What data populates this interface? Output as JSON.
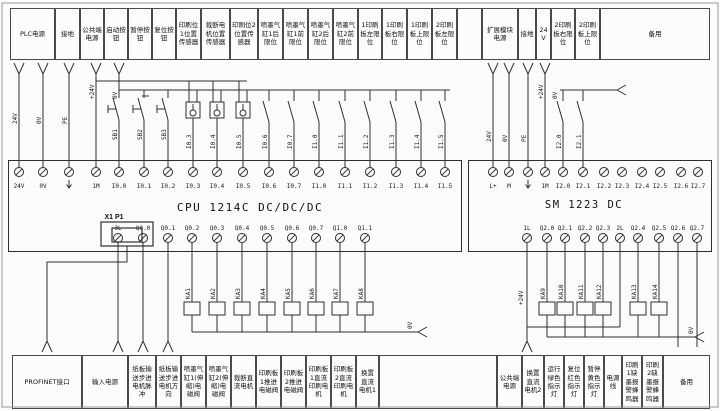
{
  "colors": {
    "line": "#2f2f2f",
    "box_border": "#4a4a4a",
    "background": "#fbfbfb",
    "text": "#111111"
  },
  "icons": {
    "ground_terminal": "ground-arrow-icon",
    "cable_entry": "v-arrow-icon",
    "wire_continuation": "fork-arrow-icon",
    "terminal": "screw-terminal-icon",
    "ethernet_port": "rj45-port-icon",
    "relay_coil": "relay-coil-icon",
    "proximity_sensor": "proximity-sensor-icon"
  },
  "top_row": [
    "PLC电源",
    "接地",
    "公共端电源",
    "启动按钮",
    "暂停按钮",
    "复位按钮",
    "印刷位1位置传感器",
    "裁断电机位置传感器",
    "印刷位2位置传感器",
    "喷墨气缸1后限位",
    "喷墨气缸1前限位",
    "喷墨气缸2后限位",
    "喷墨气缸2前限位",
    "1印刷板左限位",
    "1印刷板右限位",
    "1印刷板上限位",
    "2印刷板左限位",
    "",
    "扩展模块电源",
    "接地",
    "24V",
    "2印刷板右限位",
    "2印刷板上限位",
    "备用"
  ],
  "bottom_row": [
    "PROFINET接口",
    "输入电源",
    "纸板输送步进电机脉冲",
    "纸板输送步进电机方向",
    "喷墨气缸1(伸缩)电磁阀",
    "喷墨气缸2(伸缩)电磁阀",
    "裁断直流电机",
    "印刷板1推进电磁阀",
    "印刷板2推进电磁阀",
    "印刷板1直流印刷电机",
    "印刷板2直流印刷电机",
    "换置直流电机1",
    "",
    "公共端电源",
    "换置直流电机2",
    "运行绿色指示灯",
    "复位红色指示灯",
    "暂停黄色指示灯",
    "电源线",
    "印刷1缺墨报警蜂鸣器",
    "印刷2缺墨报警蜂鸣器",
    "备用"
  ],
  "cpu": {
    "title": "CPU 1214C DC/DC/DC",
    "port_label": "X1 P1",
    "top_terminals": [
      "24V",
      "0V",
      "⏚",
      "1M",
      "I0.0",
      "I0.1",
      "I0.2",
      "I0.3",
      "I0.4",
      "I0.5",
      "I0.6",
      "I0.7",
      "I1.0",
      "I1.1",
      "I1.2",
      "I1.3",
      "I1.4",
      "I1.5"
    ],
    "bottom_terminals": [
      "3L",
      "Q0.0",
      "Q0.1",
      "Q0.2",
      "Q0.3",
      "Q0.4",
      "Q0.5",
      "Q0.6",
      "Q0.7",
      "Q1.0",
      "Q1.1"
    ]
  },
  "sm": {
    "title": "SM 1223 DC",
    "top_terminals": [
      "L+",
      "M",
      "⏚",
      "1M",
      "I2.0",
      "I2.1",
      "I2.2",
      "I2.3",
      "I2.4",
      "I2.5",
      "I2.6",
      "I2.7"
    ],
    "bottom_terminals": [
      "1L",
      "Q2.0",
      "Q2.1",
      "Q2.2",
      "Q2.3",
      "2L",
      "Q2.4",
      "Q2.5",
      "Q2.6",
      "Q2.7"
    ]
  },
  "relays": {
    "cpu": [
      "KA1",
      "KA2",
      "KA3",
      "KA4",
      "KA5",
      "KA6",
      "KA7",
      "KA8"
    ],
    "sm": [
      "KA9",
      "KA10",
      "KA11",
      "KA12",
      "KA13",
      "KA14"
    ]
  },
  "wire_labels": {
    "left_power": [
      "24V",
      "0V",
      "PE"
    ],
    "plus_bus": "+24V",
    "zero_bus": "0V",
    "buttons": [
      "SB1",
      "SB2",
      "SB3"
    ],
    "sensor_inputs": [
      "I0.3",
      "I0.4",
      "I0.5"
    ],
    "switch_inputs": [
      "I0.6",
      "I0.7",
      "I1.0",
      "I1.1",
      "I1.2",
      "I1.3",
      "I1.4",
      "I1.5"
    ],
    "right_power": [
      "24V",
      "0V",
      "PE"
    ],
    "sm_plus_bus": "+24V",
    "sm_zero_bus": "0V",
    "sm_switch_inputs": [
      "I2.0",
      "I2.1"
    ],
    "cpu_output_bus": "0V",
    "sm_output_bus": "0V",
    "sm_output_feed": "+24V"
  }
}
